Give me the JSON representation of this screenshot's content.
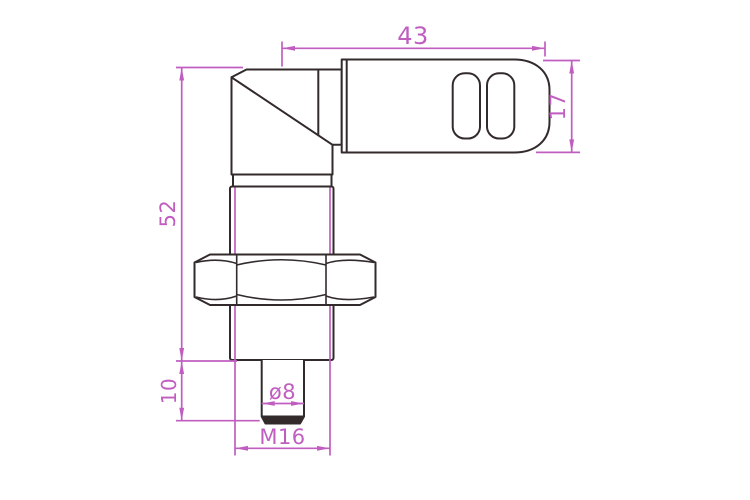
{
  "drawing": {
    "dimensions": {
      "connector_length": "43",
      "connector_height": "17",
      "body_length": "52",
      "tip_length": "10",
      "tip_diameter": "ø8",
      "thread_size": "M16"
    },
    "colors": {
      "outline": "#332b2b",
      "dimension": "#c05ec0",
      "background": "#ffffff"
    }
  }
}
